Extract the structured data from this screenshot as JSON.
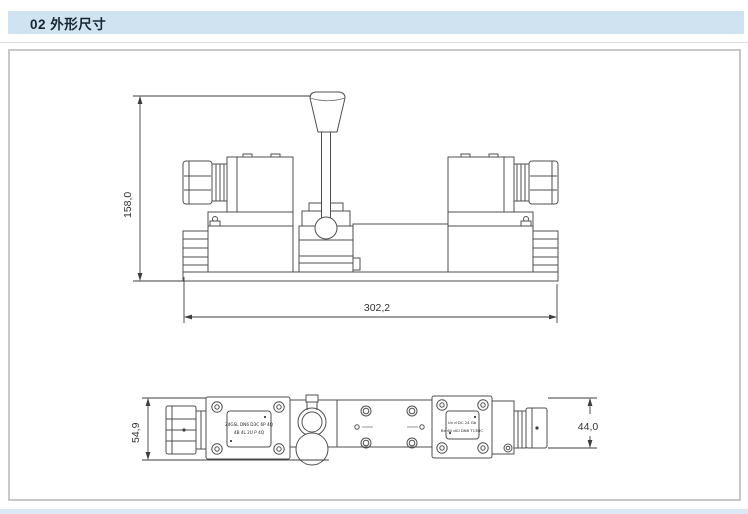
{
  "header": {
    "label": "02 外形尺寸"
  },
  "colors": {
    "header_bg": "#cfe3f1",
    "header_text": "#16262f",
    "frame_border": "#c6c8ca",
    "drawing_line": "#4f4f4f",
    "dimension_line": "#3d3d3d",
    "footer_strip": "#dce9f4"
  },
  "front_view": {
    "dim_height": "158,0",
    "dim_width": "302,2"
  },
  "bottom_view": {
    "dim_height": "54,9",
    "dim_width": "44,0",
    "left_nameplate": {
      "line1": "24GSL DN6 D3C 6P 4Q",
      "line2": "4B 4L 2U P 4Q"
    },
    "right_nameplate": {
      "line1": "Un d DC 24 Gb",
      "line2": "Bn 60 dGl DN6 T13DC"
    }
  }
}
